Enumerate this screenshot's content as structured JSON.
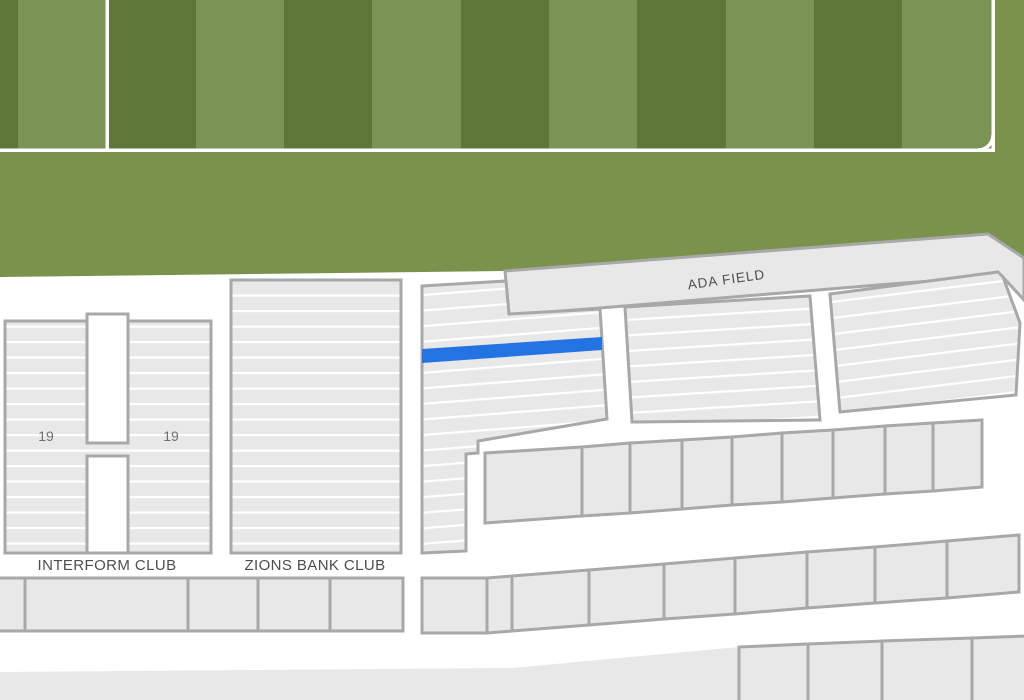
{
  "stadium_map": {
    "field_label": "ADA FIELD",
    "clubs": {
      "interform": {
        "label": "INTERFORM CLUB"
      },
      "zions": {
        "label": "ZIONS BANK CLUB"
      }
    },
    "section_numbers": [
      "19",
      "19"
    ],
    "selected_row": {
      "section_number": "19",
      "status": "selected"
    }
  },
  "colors": {
    "pitch_stripe_dark": "#5e7739",
    "pitch_stripe_light": "#7b9353",
    "pitch_apron": "#7a924c",
    "pitch_line": "#ffffff",
    "section_fill": "#e8e8e8",
    "row_line": "#ffffff",
    "border": "#a8a8a8",
    "selected_row": "#2473e3",
    "label_text": "#4e4e4e",
    "number_text": "#6f6f6f",
    "background": "#ffffff"
  }
}
